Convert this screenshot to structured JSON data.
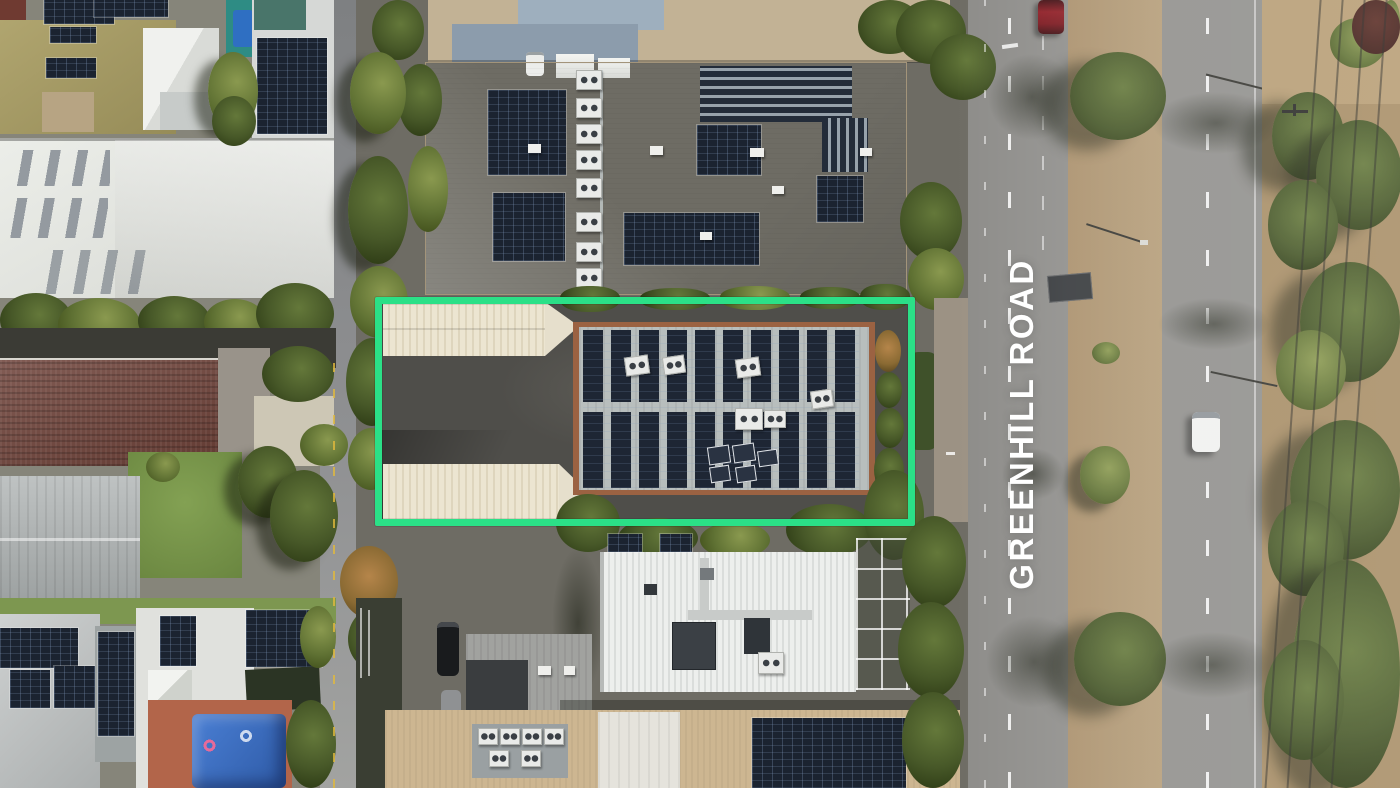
{
  "annotation": {
    "road_label": "GREENHILL ROAD",
    "boundary_color": "#2be087",
    "label_color": "#ffffff"
  }
}
